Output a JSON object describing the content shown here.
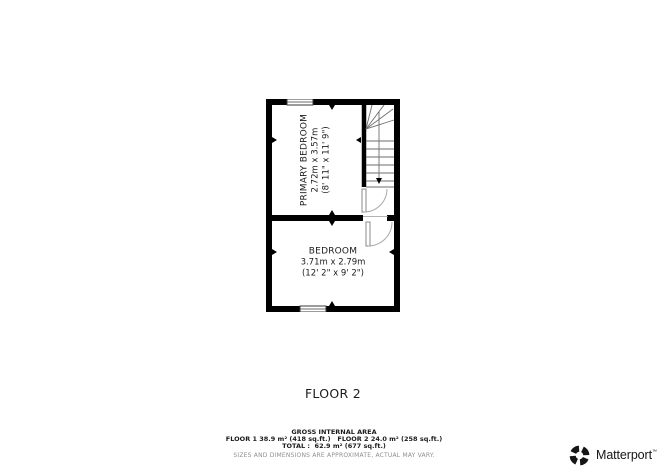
{
  "floorplan": {
    "rooms": [
      {
        "name": "PRIMARY BEDROOM",
        "metric": "2.72m x 3.57m",
        "imperial": "(8' 11\" x 11' 9\")"
      },
      {
        "name": "BEDROOM",
        "metric": "3.71m x 2.79m",
        "imperial": "(12' 2\" x 9' 2\")"
      }
    ],
    "floor_label": "FLOOR 2",
    "features": [
      "staircase",
      "stair-direction-arrow",
      "door-stairs",
      "door-bedroom",
      "window-top-wall",
      "window-bottom-wall"
    ]
  },
  "footer": {
    "title": "GROSS INTERNAL AREA",
    "areas": "FLOOR 1 38.9 m² (418 sq.ft.)   FLOOR 2 24.0 m² (258 sq.ft.)",
    "total": "TOTAL :  62.9 m² (677 sq.ft.)",
    "disclaimer": "SIZES AND DIMENSIONS ARE APPROXIMATE, ACTUAL MAY VARY."
  },
  "brand": {
    "wordmark": "Matterport",
    "trademark": "™"
  },
  "colors": {
    "wall": "#000000",
    "stair_line": "#6e6e6e",
    "door_line": "#a8a8a8",
    "window_line": "#3a3a3a",
    "text": "#1c1c1c",
    "muted_text": "#8f8f8f"
  }
}
